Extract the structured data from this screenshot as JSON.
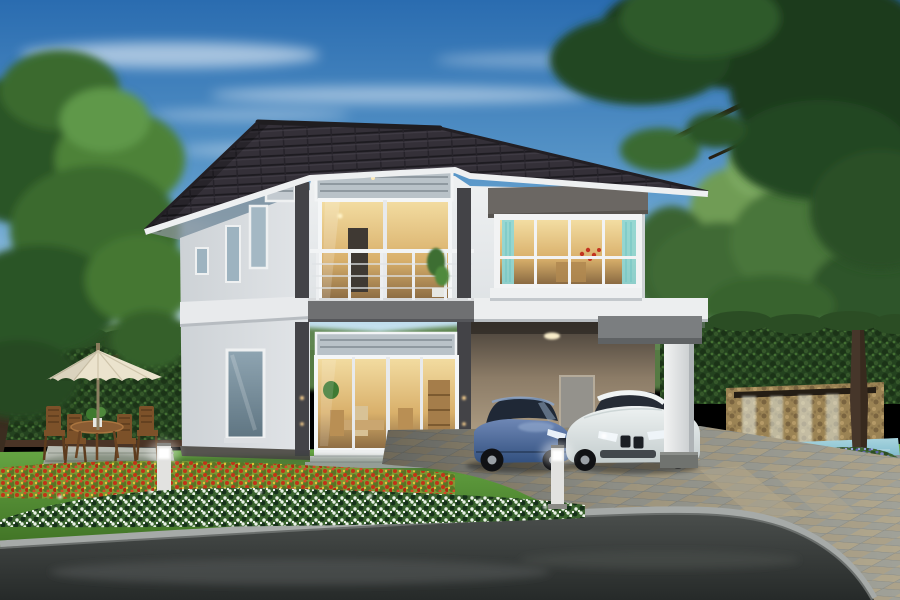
{
  "scene": {
    "description": "Dusk exterior rendering of a modern two-story house with dark tiled hip roof, lit balcony and bay window, carport with a blue sedan and a white coupe, garden patio with cream umbrella and wooden table set, bollard lights, stone waterfall feature with pool, flower beds of red, white and purple blooms, green lawn, paved driveway and asphalt road",
    "objects": [
      "sky with wispy clouds",
      "large tree left",
      "overhanging tree right",
      "distant treeline",
      "garden hedge",
      "two-story house",
      "tiled hip roof",
      "louvered transoms",
      "second-floor balcony with railing",
      "warm-lit sliding glass doors",
      "bay window with teal curtains",
      "carport",
      "blue sedan",
      "white coupe",
      "carport pillar",
      "patio umbrella",
      "wooden table and four chairs",
      "potted plant",
      "two bollard path lights",
      "stone waterfall wall",
      "blue pool",
      "red flower bed",
      "white flower bed",
      "purple flower bed",
      "green lawn",
      "checkered paver driveway",
      "asphalt road with curb"
    ]
  },
  "palette": {
    "sky_top": "#2a6cb0",
    "sky_mid": "#5e9bcb",
    "sky_horizon": "#bfe0ee",
    "cloud_white": "#ffffff",
    "treeline": "#5a8147",
    "tree_left": "#3a6b2e",
    "tree_right": "#1d3a1e",
    "hedge": "#24421f",
    "lawn_light": "#68a845",
    "lawn_dark": "#39691f",
    "roof": "#343038",
    "fascia": "#eef0f1",
    "wall_light": "#eff1f2",
    "wall_side": "#cdd2d6",
    "accent_dark": "#434347",
    "band_gray": "#6b6763",
    "glass_warm": "#f3dda2",
    "glass_cool": "#8fa5b2",
    "curtain": "#8ed7d6",
    "carport_wall": "#bcab90",
    "car_blue": "#6e87b5",
    "car_white": "#eef2f2",
    "driveway_gray": "#a0a198",
    "driveway_tan": "#b1a78d",
    "road": "#4a4e4c",
    "curb": "#a6aaa8",
    "flower_red": "#c23318",
    "flower_foliage": "#7d9733",
    "flower_white_bed": "#3a632e",
    "flower_purple": "#7d83c6",
    "umbrella": "#ebe3cd",
    "wood": "#7c5129",
    "stone": "#9b8354",
    "water": "#7ab8cb",
    "bollard": "#e2e2e0",
    "trunk": "#3b2d20"
  }
}
